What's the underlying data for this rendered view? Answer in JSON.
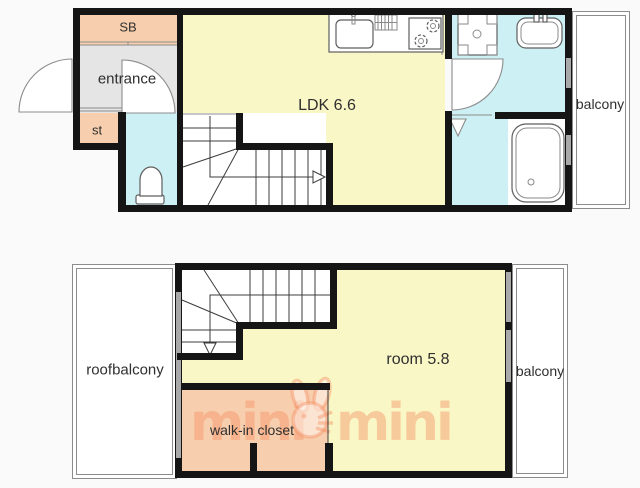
{
  "floor1": {
    "labels": {
      "sb": "SB",
      "entrance": "entrance",
      "st": "st",
      "ldk": "LDK 6.6",
      "balcony": "balcony"
    }
  },
  "floor2": {
    "labels": {
      "roofbalcony": "roofbalcony",
      "room": "room 5.8",
      "balcony": "balcony",
      "walk_in_closet": "walk-in closet"
    }
  },
  "watermark": {
    "part1": "mini",
    "part2": "mini",
    "full": "minimini"
  },
  "colors": {
    "background": "#fafafa",
    "room_yellow": "#faf7c6",
    "wet_cyan": "#cdf0f4",
    "closet_peach": "#f8cfae",
    "entrance_gray": "#e5e5e5",
    "wall": "#151515",
    "window_gray": "#a9a9a9",
    "outline_gray": "#8c8c8c",
    "fixture_stroke": "#5f5f5f",
    "watermark": "rgba(242,140,95,0.42)",
    "text": "#2f2f2f"
  },
  "icons": {
    "kitchen-sink-icon": "svg-shape",
    "stove-icon": "svg-shape",
    "washing-machine-icon": "svg-shape",
    "washbasin-icon": "svg-shape",
    "bathtub-icon": "svg-shape",
    "toilet-icon": "svg-shape",
    "door-swing-icon": "svg-arc",
    "folding-door-icon": "svg-triangle",
    "stairs-up-arrow-icon": "svg-triangle",
    "stairs-down-arrow-icon": "svg-triangle",
    "rabbit-logo-icon": "svg-shape"
  }
}
